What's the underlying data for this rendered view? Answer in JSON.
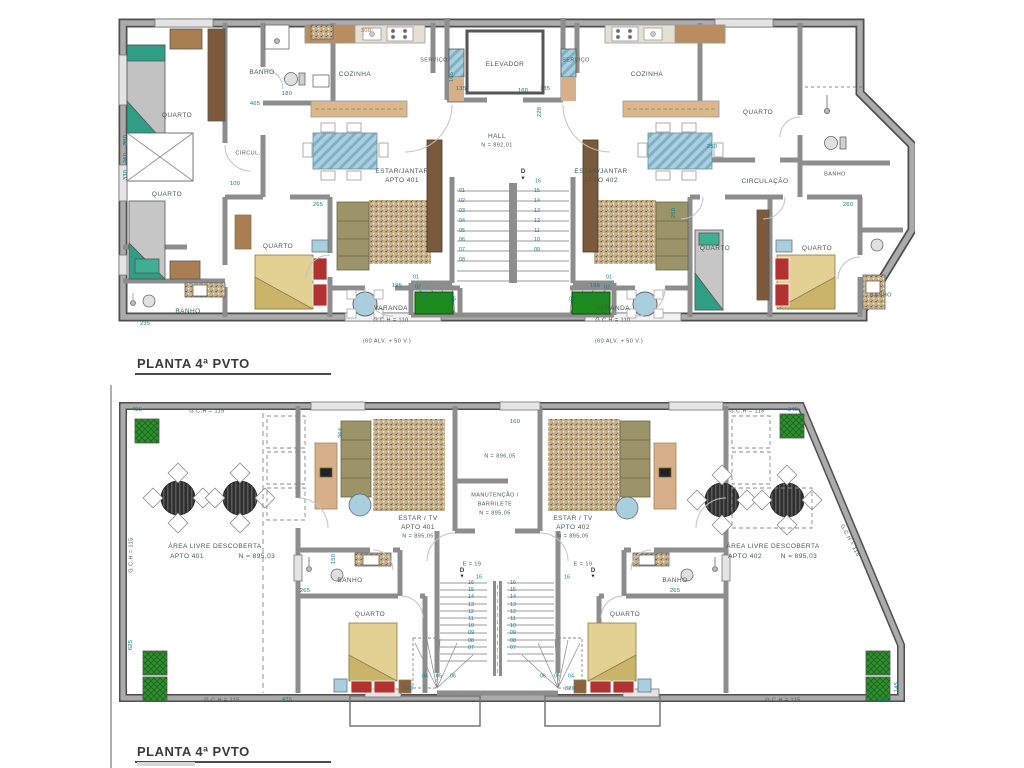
{
  "sheet": {
    "title_top": "PLANTA 4ª PVTO",
    "title_bottom": "PLANTA 4ª PVTO"
  },
  "plan_top": {
    "rooms": {
      "banho_tl": "BANHO",
      "cozinha_l": "COZINHA",
      "servico_l": "SERVIÇO",
      "elevador": "ELEVADOR",
      "servico_r": "SERVIÇO",
      "cozinha_r": "COZINHA",
      "quarto_tl": "QUARTO",
      "quarto_ml": "QUARTO",
      "quarto_tr": "QUARTO",
      "circul": "CIRCUL.",
      "circulacao": "CIRCULAÇÃO",
      "hall": "HALL",
      "hall_nivel": "N = 892,01",
      "estar_l1": "ESTAR/JANTAR",
      "estar_l2": "APTO 401",
      "estar_r1": "ESTAR/JANTAR",
      "estar_r2": "APTO 402",
      "quarto_bl": "QUARTO",
      "quarto_br1": "QUARTO",
      "quarto_br2": "QUARTO",
      "banho_bl": "BANHO",
      "banho_r1": "BANHO",
      "banho_r2": "BANHO",
      "varanda_l": "VARANDA",
      "varanda_r": "VARANDA",
      "gch_l": "G.C.H = 110",
      "gch_r": "G.C.H = 110",
      "alv_l": "(60 ALV. + 50 V.)",
      "alv_r": "(60 ALV. + 50 V.)"
    },
    "stairs": {
      "dir": "D",
      "arrow": "▼",
      "top_step": "16",
      "left": [
        "01",
        "02",
        "03",
        "04",
        "05",
        "06",
        "07",
        "08"
      ],
      "right": [
        "15",
        "14",
        "13",
        "12",
        "11",
        "10",
        "09"
      ],
      "winders_left": [
        "01",
        "02",
        "03",
        "04",
        "05"
      ],
      "winders_right": [
        "01",
        "02",
        "03",
        "04",
        "05"
      ]
    },
    "dims": {
      "d300": "300",
      "d465": "465",
      "d180": "180",
      "d165": "165",
      "d135_l": "135",
      "d160": "160",
      "d135_r": "135",
      "d228": "228",
      "d100": "100",
      "d265": "265",
      "d195_l": "195",
      "d195_r": "195",
      "d235": "235",
      "d330_a": "330",
      "d260_a": "260",
      "d330_b": "330",
      "d250_t": "250",
      "d250_r": "250",
      "d260_r": "260"
    }
  },
  "plan_bottom": {
    "rooms": {
      "area_l1": "ÁREA LIVRE DESCOBERTA",
      "area_l2": "APTO 401",
      "area_l3": "N = 895,03",
      "area_r1": "ÁREA LIVRE DESCOBERTA",
      "area_r2": "APTO 402",
      "area_r3": "N = 895,03",
      "estar_l1": "ESTAR / TV",
      "estar_l2": "APTO 401",
      "estar_l3": "N = 895,05",
      "estar_r1": "ESTAR / TV",
      "estar_r2": "APTO 402",
      "estar_r3": "N = 895,05",
      "manut1": "MANUTENÇÃO /",
      "manut2": "BARRILETE",
      "manut3": "N = 895,05",
      "nivel_top": "N = 896,05",
      "banho_l": "BANHO",
      "banho_r": "BANHO",
      "quarto_l": "QUARTO",
      "quarto_r": "QUARTO",
      "gch_tl": "G.C.H = 115",
      "gch_tr": "G.C.H = 115",
      "gch_left": "G.C.H = 115",
      "gch_bl": "G.C.H = 115",
      "gch_br": "G.C.H = 115",
      "gch_diag": "G.C.H = 115",
      "e19_l": "E = 19",
      "e19_r": "E = 19",
      "d_l": "D",
      "d_r": "D",
      "arrow": "▼",
      "s16_l": "16",
      "s16_r": "16"
    },
    "stairs": {
      "left": [
        "16",
        "15",
        "14",
        "13",
        "12",
        "11",
        "10",
        "09",
        "08",
        "07"
      ],
      "right": [
        "16",
        "15",
        "14",
        "13",
        "12",
        "11",
        "10",
        "09",
        "08",
        "07"
      ],
      "winders_left": [
        "04",
        "05",
        "06"
      ],
      "winders_right": [
        "06",
        "05",
        "04"
      ]
    },
    "dims": {
      "d495": "495",
      "d345": "345",
      "d625": "625",
      "d435": "435",
      "d580": "580",
      "d145": "145",
      "d265_l": "265",
      "d265_r": "265",
      "d160": "160",
      "d320_l": "320",
      "d320_r": "320",
      "d150": "150",
      "d364": "364"
    }
  }
}
